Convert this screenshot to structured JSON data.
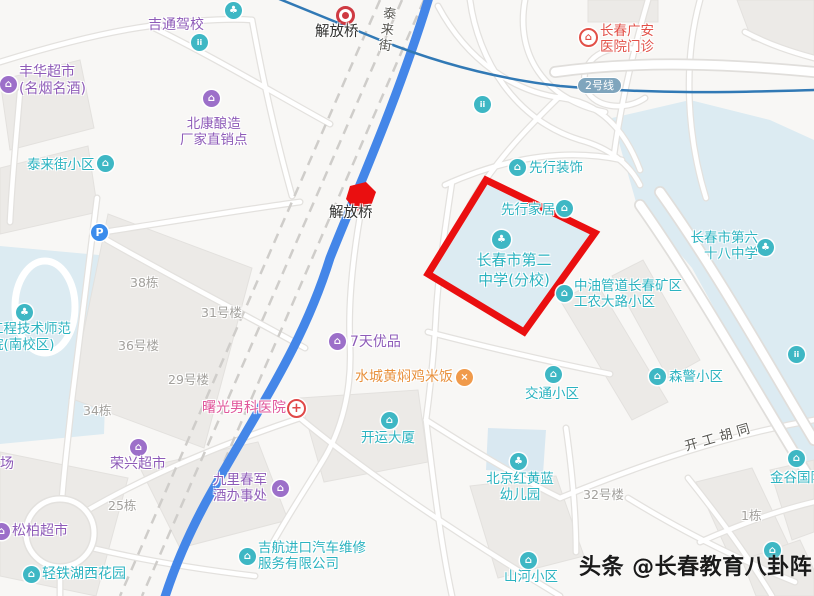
{
  "watermark": {
    "text": "头条 @长春教育八卦阵"
  },
  "metro": {
    "line_badge": "2号线"
  },
  "road_labels": {
    "tailai_street": "泰来街",
    "kaigong_hutong": "开工胡同"
  },
  "markers": {
    "jiefangqiao_station": "解放桥",
    "jiefangqiao_bridge": "解放桥"
  },
  "highlight_school": {
    "line1": "长春市第二",
    "line2": "中学(分校)"
  },
  "pois": {
    "jitong": {
      "name": "吉通驾校"
    },
    "fenghua": {
      "line1": "丰华超市",
      "line2": "(名烟名酒)"
    },
    "beikang": {
      "line1": "北康酿造",
      "line2": "厂家直销点"
    },
    "tailai_xiaoqu": {
      "name": "泰来街小区"
    },
    "guangan": {
      "line1": "长春广安",
      "line2": "医院门诊"
    },
    "xianxing_zhuangshi": {
      "name": "先行装饰"
    },
    "xianxing_jiaju": {
      "name": "先行家居"
    },
    "zhongyou": {
      "line1": "中油管道长春矿区",
      "line2": "工农大路小区"
    },
    "school68": {
      "line1": "长春市第六",
      "line2": "十八中学"
    },
    "senjing": {
      "name": "森警小区"
    },
    "jiaotong": {
      "name": "交通小区"
    },
    "college": {
      "line1": "工程技术师范",
      "line2": "院(南校区)"
    },
    "qitian": {
      "name": "7天优品"
    },
    "shuicheng": {
      "name": "水城黄焖鸡米饭"
    },
    "shuguang": {
      "name": "曙光男科医院"
    },
    "rongxing": {
      "name": "荣兴超市"
    },
    "songbai": {
      "name": "松柏超市"
    },
    "qingtie": {
      "name": "轻铁湖西花园"
    },
    "jiuli": {
      "line1": "九里春军",
      "line2": "酒办事处"
    },
    "jihang": {
      "line1": "吉航进口汽车维修",
      "line2": "服务有限公司"
    },
    "kaiyun": {
      "name": "开运大厦"
    },
    "honghuanglan": {
      "line1": "北京红黄蓝",
      "line2": "幼儿园"
    },
    "shanhe": {
      "name": "山河小区"
    },
    "jingu": {
      "name": "金谷国际"
    },
    "shichang": {
      "name": "市场"
    }
  },
  "building_labels": {
    "b38": "38栋",
    "b31": "31号楼",
    "b36": "36号楼",
    "b29": "29号楼",
    "b34": "34栋",
    "b25": "25栋",
    "b32": "32号楼",
    "b1": "1栋"
  },
  "icons": {
    "community": "⌂",
    "school": "♣",
    "shop": "⌂",
    "restaurant": "×",
    "hospital_cross": "+",
    "house": "⌂",
    "parking": "P",
    "people": "ii",
    "car": "⌂"
  },
  "colors": {
    "highlight_red": "#ea0f10",
    "road_blue": "#4486e8",
    "metro_blue": "#3179b5",
    "poi_teal": "#2bb3c0",
    "poi_purple": "#8e5bb8",
    "poi_orange": "#e8913d",
    "hospital_red": "#e25048",
    "clinic_pink": "#e0579b",
    "campus_blue": "#dcebf2"
  }
}
